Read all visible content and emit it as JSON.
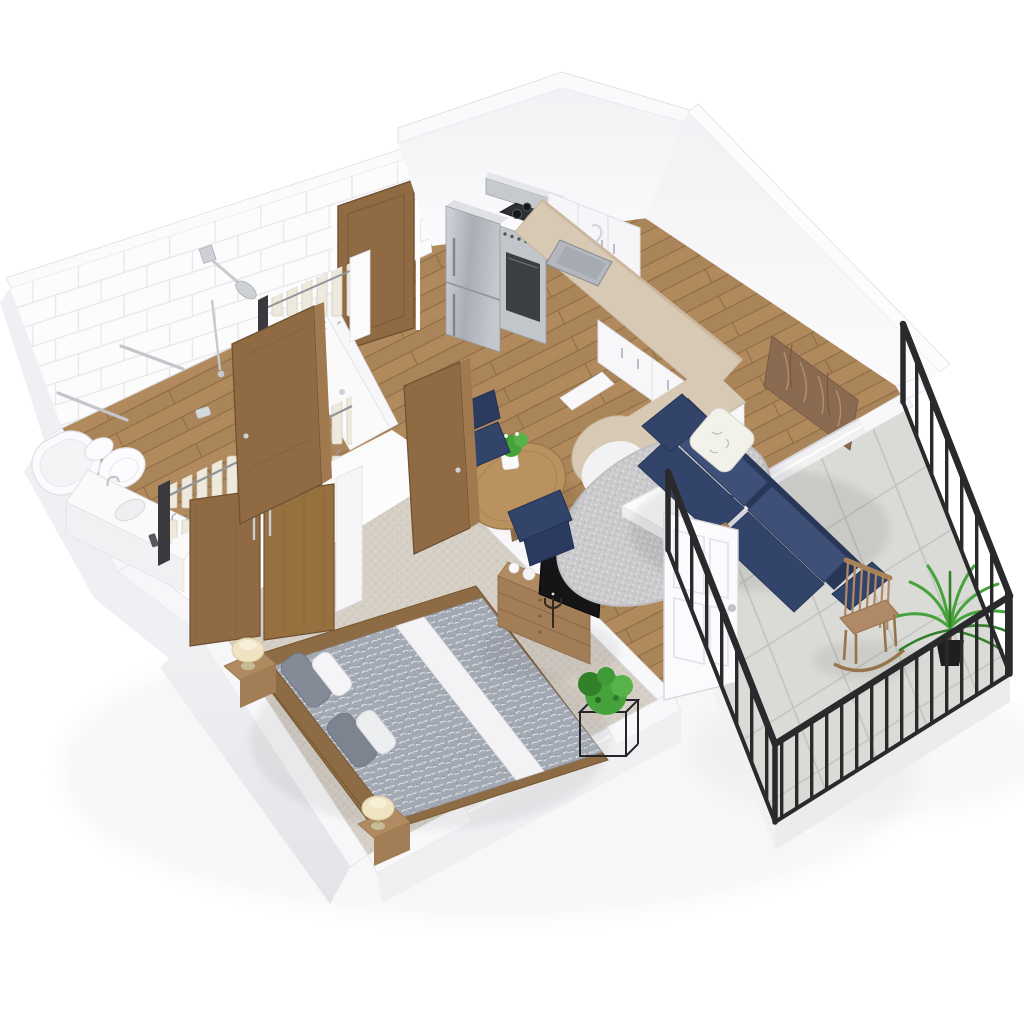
{
  "scene": {
    "title": "3D isometric floor plan rendering of a one-bedroom apartment",
    "style": "cutaway dollhouse view, white background, no visible text",
    "rooms": [
      {
        "id": "bathroom",
        "label": "Bathroom",
        "floor": "wood",
        "walls": "white-tile",
        "furniture": [
          "bathtub",
          "toilet",
          "vanity-sink",
          "shower-area",
          "shower-fixtures",
          "towel-bar",
          "towel-bar",
          "toilet-paper-holder"
        ]
      },
      {
        "id": "hall-closet",
        "label": "Hall closet",
        "furniture": [
          "hanging-clothes",
          "clothes-rail",
          "white-divider-panel"
        ]
      },
      {
        "id": "kitchen",
        "label": "Kitchen",
        "floor": "wood",
        "furniture": [
          "refrigerator",
          "gas-range",
          "range-hood",
          "upper-cabinets",
          "base-cabinets",
          "beige-countertop",
          "kitchen-sink",
          "faucet",
          "peninsula-counter"
        ]
      },
      {
        "id": "living-room",
        "label": "Living / dining room",
        "floor": "wood",
        "furniture": [
          "navy-loveseat",
          "floral-throw-pillow",
          "wall-art-panel",
          "round-shag-rug",
          "coffee-table",
          "laptop",
          "round-dining-table",
          "dining-chair",
          "dining-chair",
          "table-centerpiece-plant"
        ]
      },
      {
        "id": "bedroom",
        "label": "Bedroom",
        "floor": "carpet",
        "furniture": [
          "double-bed",
          "gray-patterned-duvet",
          "wood-headboard",
          "nightstand",
          "nightstand",
          "table-lamp",
          "table-lamp",
          "wardrobe-sliding-doors",
          "hanging-clothes",
          "dresser",
          "tv",
          "decor-vases",
          "candelabra",
          "potted-plant-on-stand",
          "window"
        ]
      },
      {
        "id": "balcony",
        "label": "Balcony",
        "floor": "tile",
        "furniture": [
          "black-metal-railing",
          "wood-rocking-chair",
          "potted-palm",
          "window-opening"
        ]
      }
    ],
    "doors": [
      {
        "id": "entry-door",
        "material": "wood",
        "state": "closed"
      },
      {
        "id": "bathroom-door",
        "material": "wood",
        "state": "open"
      },
      {
        "id": "bedroom-door",
        "material": "wood",
        "state": "open"
      },
      {
        "id": "balcony-door",
        "material": "white-panel",
        "state": "open"
      }
    ],
    "palette": {
      "bg": "#ffffff",
      "wall-white": "#f7f7f9",
      "wall-shade": "#e9e9ed",
      "wall-edge": "#dcdce1",
      "tile-grout": "#e6e6ea",
      "wood-floor": "#b0895c",
      "wood-floor-dark": "#9b7348",
      "wood-door": "#8f6a42",
      "wood-door-dark": "#6f5233",
      "carpet": "#d5cfc6",
      "balcony-tile": "#dadad6",
      "balcony-tile-line": "#c3c3be",
      "railing-black": "#2a2a2c",
      "sofa-navy": "#33446b",
      "sofa-navy-light": "#3e5078",
      "sofa-navy-dark": "#283757",
      "counter-beige": "#d8c9b4",
      "stainless": "#bcc0c6",
      "stainless-dark": "#8f949b",
      "rug-gray": "#cbcbcd",
      "duvet-gray": "#a3a9b3",
      "lamp-cream": "#efe3c2",
      "plant-green": "#46a33b",
      "plant-green-dark": "#33802b",
      "art-brown": "#8a6a50",
      "furniture-wood": "#a67e54"
    }
  }
}
